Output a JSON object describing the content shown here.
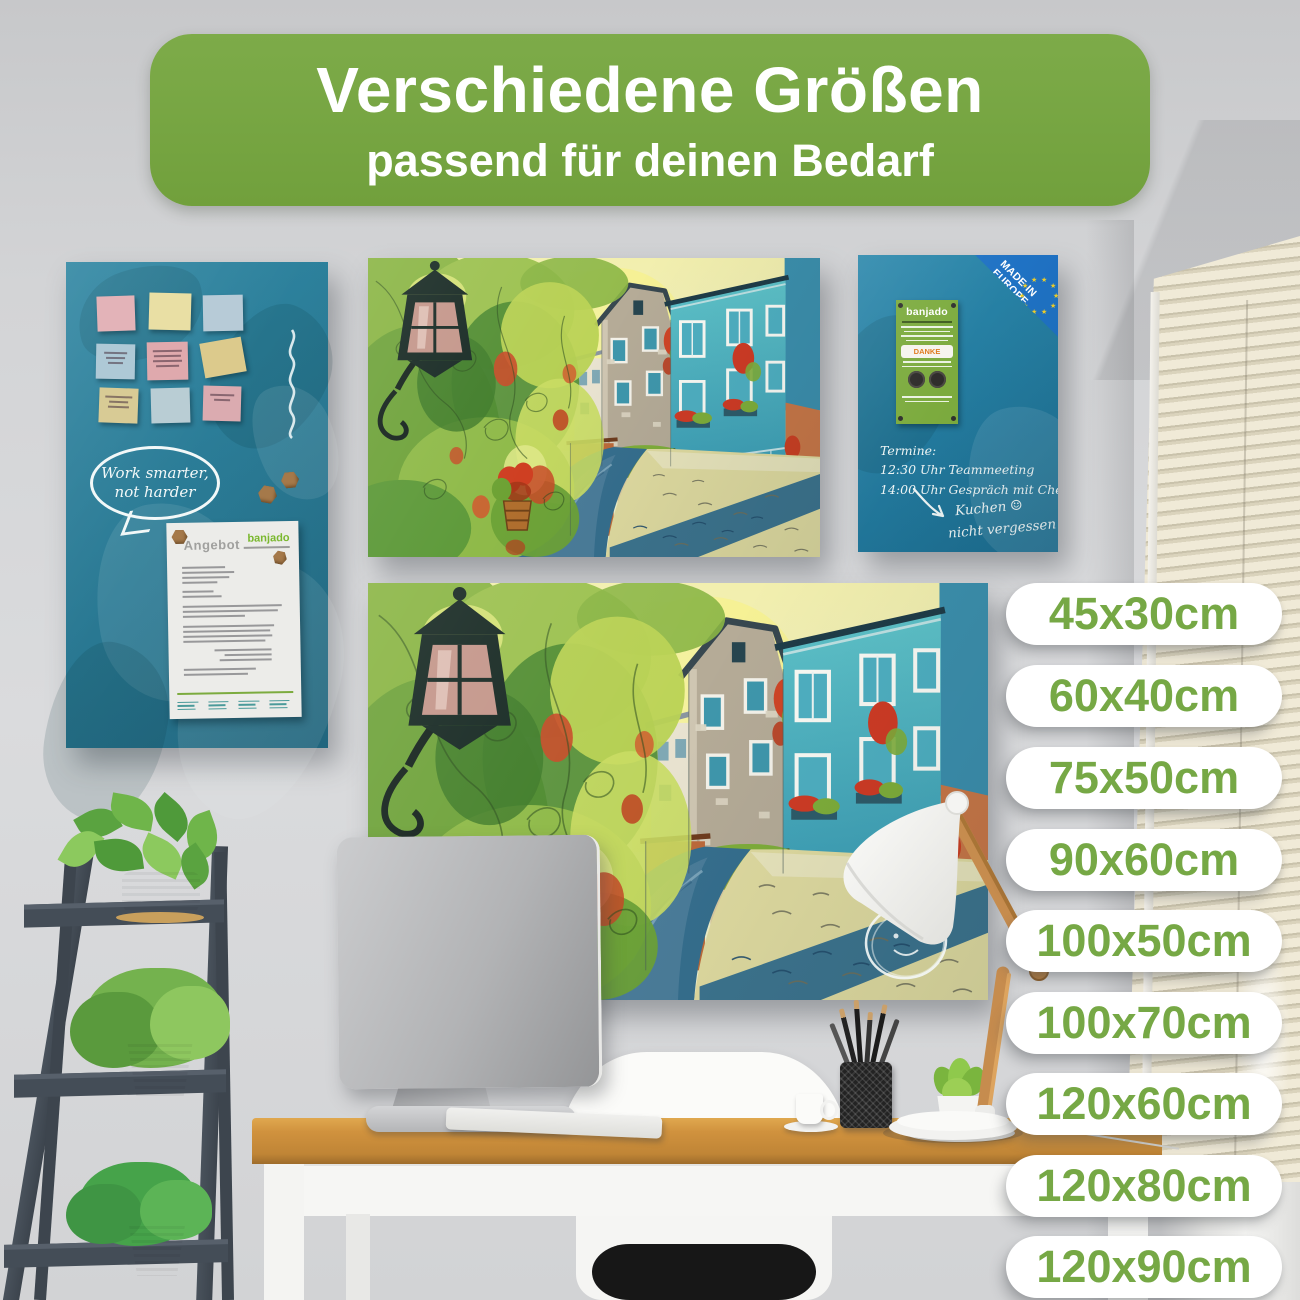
{
  "banner": {
    "title": "Verschiedene Größen",
    "subtitle": "passend für deinen Bedarf"
  },
  "sizes": [
    "45x30cm",
    "60x40cm",
    "75x50cm",
    "90x60cm",
    "100x50cm",
    "100x70cm",
    "120x60cm",
    "120x80cm",
    "120x90cm"
  ],
  "left_board": {
    "bubble_line1": "Work smarter,",
    "bubble_line2": "not harder",
    "document": {
      "title": "Angebot",
      "brand": "banjado"
    }
  },
  "right_board": {
    "corner_line1": "MADE IN",
    "corner_line2": "EUROPE",
    "flyer_brand": "banjado",
    "flyer_thanks": "DANKE",
    "schedule_line1": "Termine:",
    "schedule_line2": "12:30 Uhr Teammeeting",
    "schedule_line3": "14:00 Uhr Gespräch mit Chefin",
    "reminder_line1": "Kuchen",
    "reminder_line2": "nicht vergessen",
    "smiley": "☺"
  },
  "colors": {
    "brand_green": "#78a746",
    "pill_text_green": "#76a845",
    "left_board_teal": "#2b7e99",
    "right_board_blue": "#2380a6",
    "eu_corner_blue": "#1f72c4",
    "eu_star_yellow": "#f2d028"
  }
}
